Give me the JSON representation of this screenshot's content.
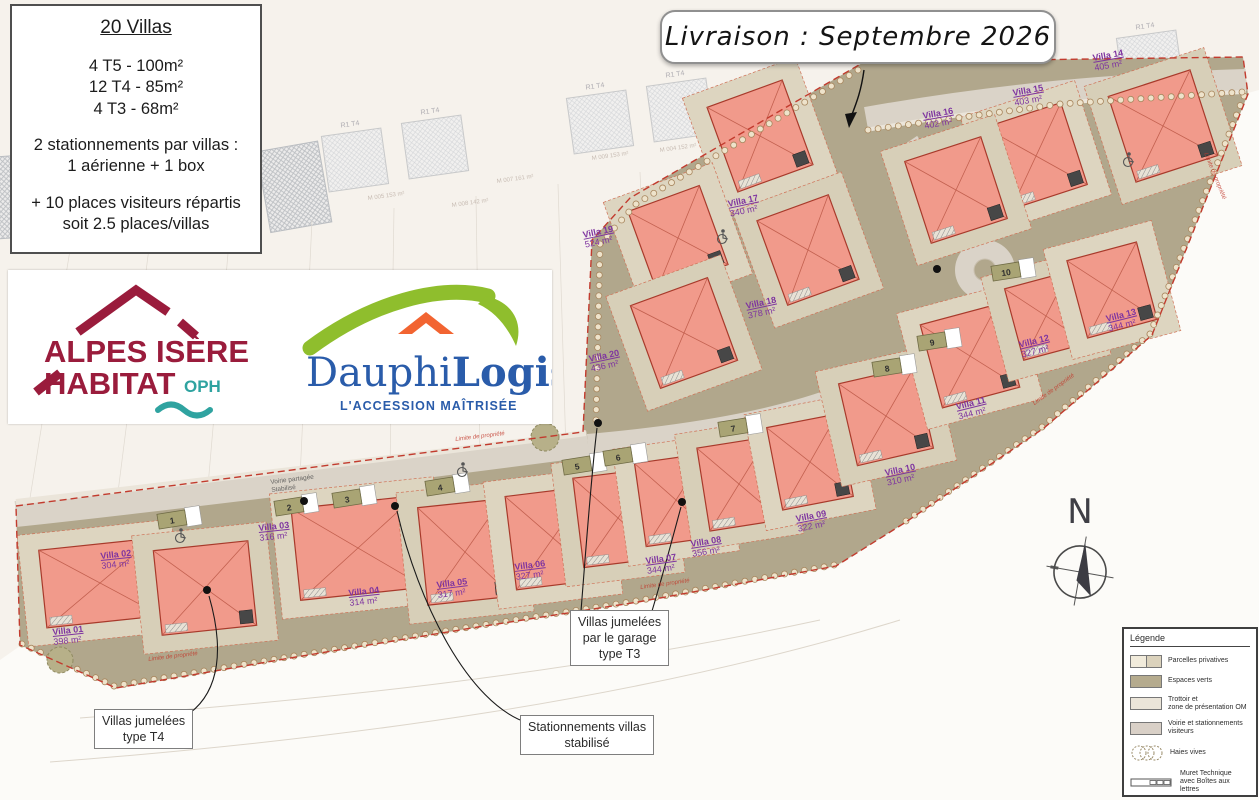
{
  "info_box": {
    "title": "20 Villas",
    "unit_lines": [
      "4 T5 - 100m²",
      "12 T4 - 85m²",
      "4 T3 - 68m²"
    ],
    "parking_lines": [
      "2 stationnements par villas :",
      "1 aérienne + 1 box"
    ],
    "visitor_lines": [
      "+ 10 places visiteurs répartis",
      "soit 2.5 places/villas"
    ]
  },
  "banner": {
    "text": "Livraison : Septembre 2026"
  },
  "logo_alpes": {
    "line1": "ALPES ISÈRE",
    "line2": "HABITAT",
    "suffix": "OPH",
    "colors": {
      "red": "#9a1c3c",
      "teal": "#2fa3a0"
    }
  },
  "logo_dauphi": {
    "name_regular": "Dauphi",
    "name_bold": "Logis",
    "tagline": "L'ACCESSION MAÎTRISÉE",
    "colors": {
      "blue": "#2a5caa",
      "green": "#8fbe2d",
      "orange": "#f26431"
    }
  },
  "north": {
    "label": "N"
  },
  "legend": {
    "title": "Légende",
    "items": [
      {
        "key": "parcelles",
        "lines": [
          "Parcelles privatives"
        ]
      },
      {
        "key": "espaces",
        "lines": [
          "Espaces verts"
        ]
      },
      {
        "key": "trottoir",
        "lines": [
          "Trottoir et",
          "zone de présentation OM"
        ]
      },
      {
        "key": "voirie",
        "lines": [
          "Voirie et stationnements",
          "visiteurs"
        ]
      },
      {
        "key": "haies",
        "lines": [
          "Haies vives"
        ]
      },
      {
        "key": "muret",
        "lines": [
          "Muret Technique",
          "avec Boîtes aux lettres"
        ]
      }
    ]
  },
  "callouts": [
    {
      "id": "t4",
      "lines": [
        "Villas jumelées",
        "type T4"
      ]
    },
    {
      "id": "t3",
      "lines": [
        "Villas jumelées",
        "par le garage",
        "type T3"
      ]
    },
    {
      "id": "stat",
      "lines": [
        "Stationnements villas",
        "stabilisé"
      ]
    }
  ],
  "villas": [
    {
      "name": "Villa 01",
      "area": "398 m²",
      "label": [
        52,
        628,
        -6
      ],
      "house": [
        100,
        583,
        115,
        78,
        -6
      ]
    },
    {
      "name": "Villa 02",
      "area": "304 m²",
      "label": [
        100,
        552,
        -6
      ],
      "house": [
        205,
        588,
        95,
        85,
        -6
      ]
    },
    {
      "name": "Villa 03",
      "area": "316 m²",
      "label": [
        258,
        524,
        -6
      ],
      "house": [
        358,
        548,
        125,
        92,
        -6
      ]
    },
    {
      "name": "Villa 04",
      "area": "314 m²",
      "label": [
        348,
        589,
        -6
      ],
      "house": [
        465,
        552,
        85,
        98,
        -6
      ]
    },
    {
      "name": "Villa 05",
      "area": "317 m²",
      "label": [
        436,
        581,
        -7
      ],
      "house": [
        553,
        538,
        85,
        94,
        -7
      ]
    },
    {
      "name": "Villa 06",
      "area": "327 m²",
      "label": [
        514,
        563,
        -7
      ],
      "house": [
        618,
        518,
        80,
        90,
        -7
      ]
    },
    {
      "name": "Villa 07",
      "area": "344 m²",
      "label": [
        645,
        557,
        -8
      ],
      "house": [
        676,
        500,
        72,
        84,
        -8
      ]
    },
    {
      "name": "Villa 08",
      "area": "356 m²",
      "label": [
        690,
        540,
        -9
      ],
      "house": [
        739,
        484,
        72,
        84,
        -9
      ]
    },
    {
      "name": "Villa 09",
      "area": "322 m²",
      "label": [
        795,
        515,
        -11
      ],
      "house": [
        810,
        462,
        72,
        84,
        -11
      ]
    },
    {
      "name": "Villa 10",
      "area": "310 m²",
      "label": [
        884,
        469,
        -12
      ],
      "house": [
        886,
        416,
        78,
        84,
        -13
      ]
    },
    {
      "name": "Villa 11",
      "area": "344 m²",
      "label": [
        955,
        403,
        -14
      ],
      "house": [
        970,
        356,
        80,
        86,
        -15
      ]
    },
    {
      "name": "Villa 12",
      "area": "327 m²",
      "label": [
        1018,
        341,
        -14
      ],
      "house": [
        1046,
        316,
        66,
        74,
        -15
      ]
    },
    {
      "name": "Villa 13",
      "area": "344 m²",
      "label": [
        1105,
        315,
        -14
      ],
      "house": [
        1112,
        290,
        72,
        80,
        -15
      ]
    },
    {
      "name": "Villa 14",
      "area": "405 m²",
      "label": [
        1092,
        54,
        -10
      ],
      "house": [
        1163,
        126,
        86,
        90,
        -18
      ]
    },
    {
      "name": "Villa 15",
      "area": "403 m²",
      "label": [
        1012,
        89,
        -10
      ],
      "house": [
        1036,
        156,
        80,
        86,
        -18
      ]
    },
    {
      "name": "Villa 16",
      "area": "402 m²",
      "label": [
        922,
        112,
        -10
      ],
      "house": [
        956,
        190,
        80,
        86,
        -18
      ]
    },
    {
      "name": "Villa 17",
      "area": "340 m²",
      "label": [
        727,
        200,
        -12
      ],
      "house": [
        760,
        136,
        80,
        90,
        -20
      ]
    },
    {
      "name": "Villa 18",
      "area": "378 m²",
      "label": [
        745,
        302,
        -12
      ],
      "house": [
        808,
        250,
        76,
        90,
        -20
      ]
    },
    {
      "name": "Villa 19",
      "area": "524 m²",
      "label": [
        582,
        231,
        -12
      ],
      "house": [
        678,
        238,
        76,
        84,
        -20
      ]
    },
    {
      "name": "Villa 20",
      "area": "436 m²",
      "label": [
        588,
        355,
        -12
      ],
      "house": [
        684,
        333,
        82,
        88,
        -20
      ]
    }
  ],
  "road_markers": [
    "1",
    "2",
    "3",
    "4",
    "5",
    "6",
    "7",
    "8",
    "9",
    "10"
  ],
  "plan_texts": {
    "limite": "Limite de propriété",
    "voirie_partagee": [
      "Voirie partagée",
      "Stabilisé"
    ],
    "neighbor_building": "R1 T4",
    "neighbor_parcels": [
      {
        "text": "M 007  161 m²",
        "x": 497,
        "y": 183
      },
      {
        "text": "M 009  153 m²",
        "x": 592,
        "y": 160
      },
      {
        "text": "M 004  152 m²",
        "x": 660,
        "y": 152
      },
      {
        "text": "M 003  153 m²",
        "x": 706,
        "y": 138
      },
      {
        "text": "M 005  153 m²",
        "x": 368,
        "y": 200
      },
      {
        "text": "M 008  142 m²",
        "x": 452,
        "y": 207
      }
    ]
  },
  "colors": {
    "villa_fill": "#f19a8b",
    "villa_border": "#a83a2b",
    "green_space": "#b1a78c",
    "road": "#dad3c8",
    "boundary_red": "#c23b2e",
    "label_purple": "#7e34a0",
    "parcel_beige": "#d7cfb8"
  }
}
